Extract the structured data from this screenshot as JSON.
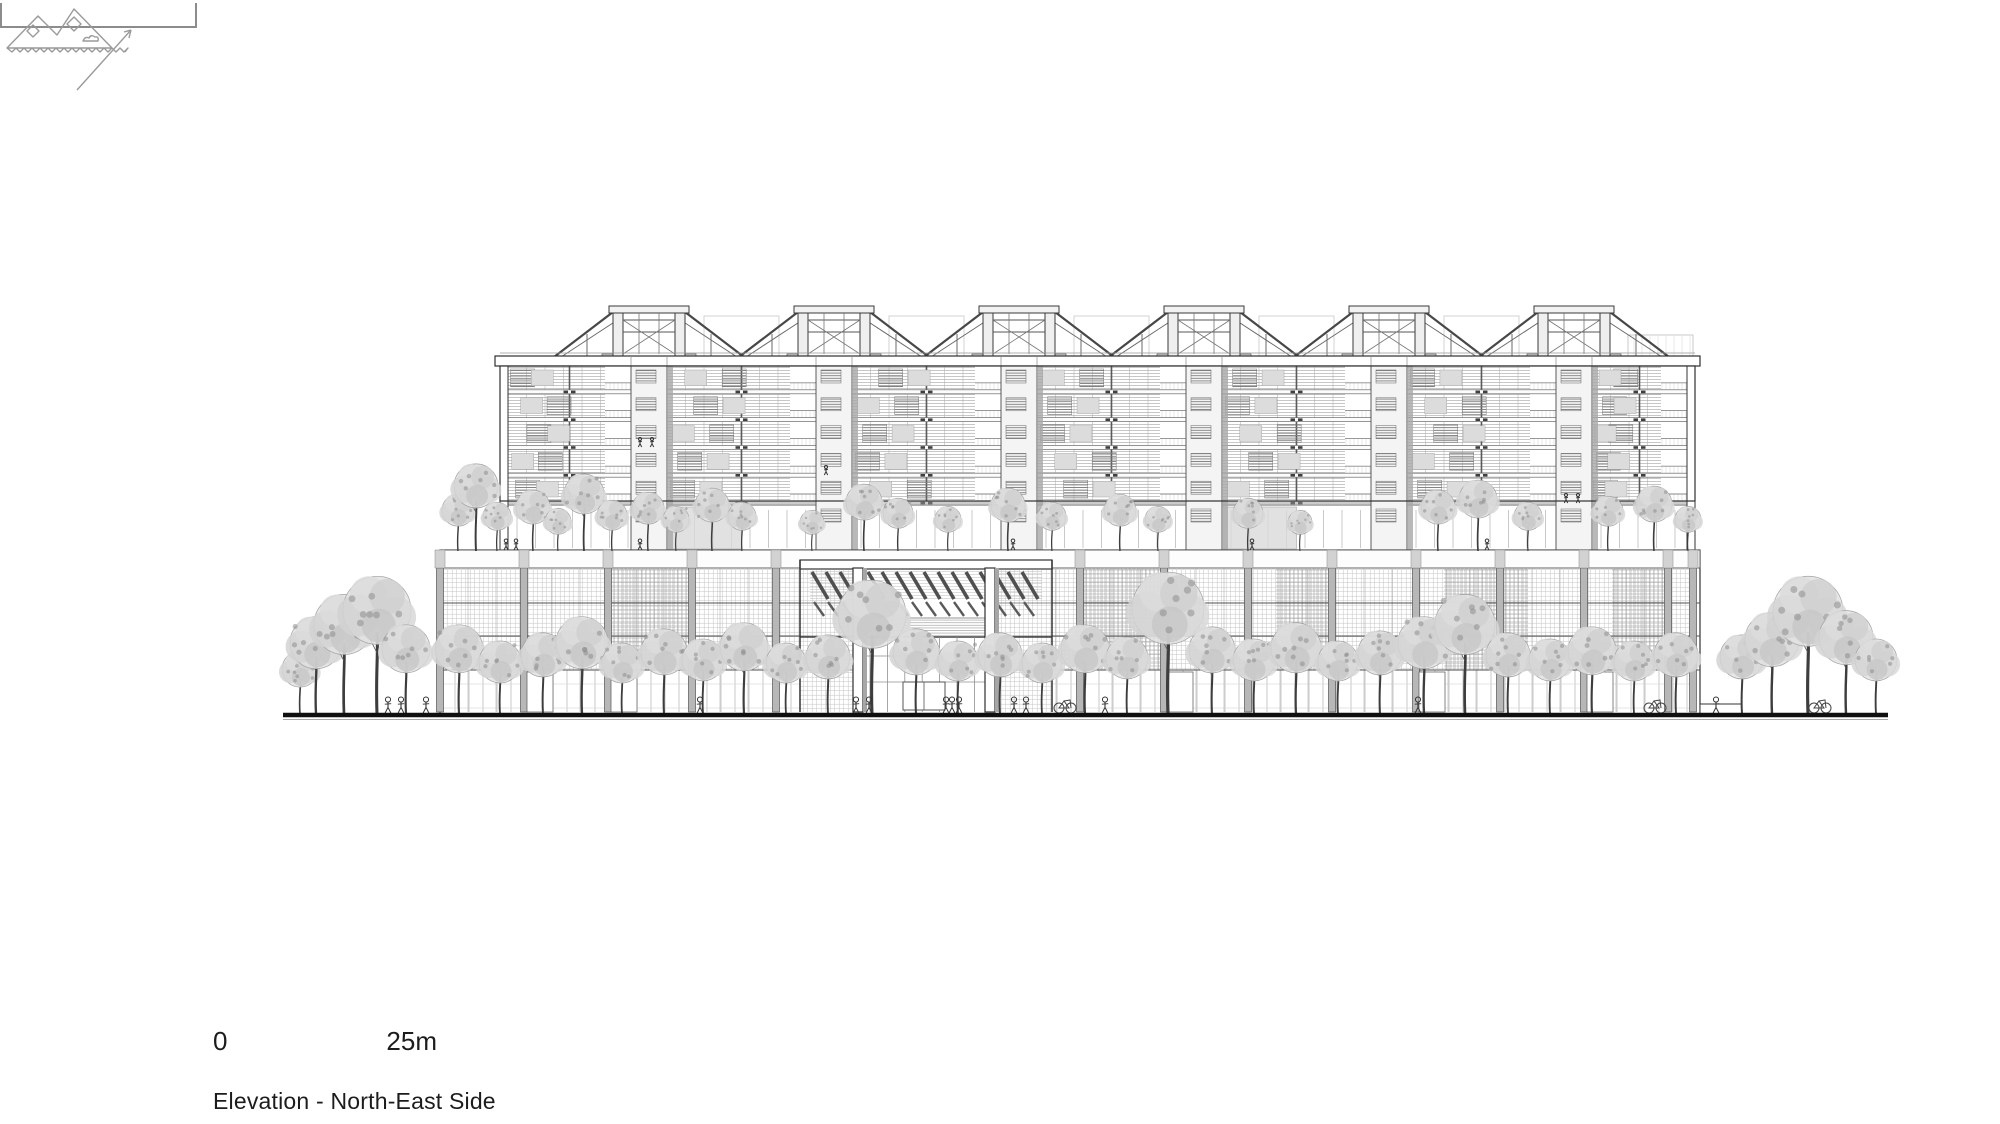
{
  "page": {
    "width": 2000,
    "height": 1124,
    "background": "#ffffff"
  },
  "titleblock": {
    "scale_start_label": "0",
    "scale_end_label": "25m",
    "caption": "Elevation - North-East Side"
  },
  "icons": {
    "logo": "site-plan-mountains-logo-icon",
    "arrow": "view-direction-arrow-icon"
  },
  "palette": {
    "line_dark": "#2e2e2e",
    "line_mid": "#6f6f6f",
    "line_light": "#b9b9b9",
    "fill_light": "#ededed",
    "fill_mid": "#d6d6d6",
    "fill_shadow": "#a8a8a8",
    "ground": "#101010",
    "scalebar": "#8c8c8c",
    "text": "#1c1c1c"
  },
  "drawing": {
    "ground": {
      "x1": 283,
      "x2": 1888,
      "y": 715
    },
    "upper_block": {
      "x1": 500,
      "x2": 1695,
      "top": 366,
      "roof_top": 356,
      "floors": 5,
      "floor_pitch": 27.8,
      "slab_h": 4,
      "transition_bottom": 550,
      "cores": [
        649,
        834,
        1019,
        1204,
        1389,
        1574
      ],
      "core_width": 36
    },
    "trusses": {
      "centers": [
        649,
        834,
        1019,
        1204,
        1389,
        1574
      ],
      "top": 308,
      "base": 358,
      "half_span": 95
    },
    "podium": {
      "x1": 440,
      "x2": 1700,
      "top": 550,
      "facade_top": 568,
      "bottom": 715,
      "slabs": [
        603,
        636,
        670
      ],
      "piers": [
        440,
        524,
        608,
        692,
        776,
        1080,
        1164,
        1248,
        1332,
        1416,
        1500,
        1584,
        1668,
        1693
      ],
      "dark_bays": [
        [
          608,
          692
        ],
        [
          1080,
          1164
        ],
        [
          1276,
          1332
        ],
        [
          1444,
          1528
        ],
        [
          1612,
          1668
        ]
      ],
      "doors": [
        527,
        611,
        1167,
        1419,
        1587
      ]
    },
    "entrance": {
      "x1": 800,
      "x2": 1052,
      "pier_left": 853,
      "pier_right": 985,
      "pier_w": 10,
      "canopy_y": 560,
      "slat_row1": [
        572,
        599
      ],
      "slat_row2": [
        602,
        616
      ],
      "louver_band": [
        618,
        637
      ],
      "glass_top": 637,
      "door": [
        903,
        945,
        682,
        710
      ]
    },
    "right_wall": {
      "x": 1700,
      "w": 42,
      "y": 704,
      "h": 11
    },
    "street_trees": [
      [
        300,
        62,
        18
      ],
      [
        316,
        96,
        26
      ],
      [
        344,
        118,
        30
      ],
      [
        377,
        136,
        34
      ],
      [
        406,
        88,
        24
      ],
      [
        459,
        88,
        24
      ],
      [
        500,
        72,
        21
      ],
      [
        543,
        80,
        22
      ],
      [
        582,
        96,
        26
      ],
      [
        622,
        70,
        20
      ],
      [
        664,
        84,
        23
      ],
      [
        703,
        74,
        21
      ],
      [
        744,
        90,
        24
      ],
      [
        786,
        70,
        20
      ],
      [
        828,
        78,
        22
      ],
      [
        872,
        132,
        34
      ],
      [
        916,
        84,
        23
      ],
      [
        958,
        72,
        20
      ],
      [
        1000,
        80,
        22
      ],
      [
        1042,
        70,
        20
      ],
      [
        1085,
        88,
        24
      ],
      [
        1127,
        76,
        21
      ],
      [
        1168,
        140,
        36
      ],
      [
        1212,
        86,
        23
      ],
      [
        1254,
        74,
        21
      ],
      [
        1296,
        90,
        25
      ],
      [
        1338,
        72,
        20
      ],
      [
        1380,
        82,
        22
      ],
      [
        1424,
        96,
        26
      ],
      [
        1465,
        118,
        30
      ],
      [
        1508,
        80,
        22
      ],
      [
        1550,
        74,
        21
      ],
      [
        1592,
        86,
        24
      ],
      [
        1634,
        72,
        20
      ],
      [
        1676,
        80,
        22
      ],
      [
        1742,
        78,
        22
      ],
      [
        1772,
        100,
        27
      ],
      [
        1808,
        136,
        35
      ],
      [
        1846,
        102,
        27
      ],
      [
        1876,
        74,
        21
      ]
    ],
    "terrace_trees": [
      [
        458,
        56,
        16
      ],
      [
        476,
        86,
        22
      ],
      [
        497,
        48,
        14
      ],
      [
        533,
        60,
        17
      ],
      [
        558,
        42,
        13
      ],
      [
        584,
        76,
        20
      ],
      [
        612,
        50,
        15
      ],
      [
        648,
        58,
        16
      ],
      [
        676,
        44,
        13
      ],
      [
        712,
        62,
        17
      ],
      [
        742,
        48,
        14
      ],
      [
        812,
        40,
        12
      ],
      [
        864,
        66,
        18
      ],
      [
        898,
        52,
        15
      ],
      [
        948,
        44,
        13
      ],
      [
        1008,
        62,
        17
      ],
      [
        1052,
        48,
        14
      ],
      [
        1120,
        56,
        16
      ],
      [
        1158,
        44,
        13
      ],
      [
        1248,
        52,
        15
      ],
      [
        1300,
        40,
        12
      ],
      [
        1438,
        60,
        17
      ],
      [
        1478,
        70,
        19
      ],
      [
        1528,
        48,
        14
      ],
      [
        1608,
        54,
        15
      ],
      [
        1654,
        64,
        18
      ],
      [
        1688,
        44,
        13
      ]
    ],
    "street_people": [
      388,
      401,
      426,
      700,
      952,
      1105,
      1418,
      1716,
      856,
      869,
      946,
      959,
      1014,
      1026
    ],
    "terrace_people": [
      506,
      516,
      640,
      1013,
      1252,
      1487
    ],
    "balcony_people": [
      [
        640,
        447
      ],
      [
        652,
        447
      ],
      [
        826,
        475
      ],
      [
        1566,
        503
      ],
      [
        1578,
        503
      ]
    ],
    "bikes": [
      1065,
      1655,
      1820
    ]
  }
}
